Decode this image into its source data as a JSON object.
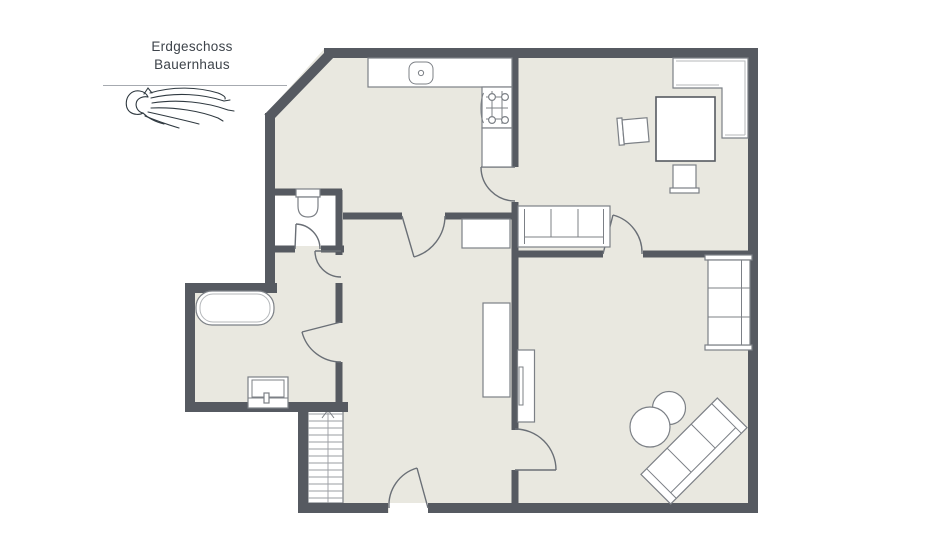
{
  "logo": {
    "title_line1": "Erdgeschoss",
    "title_line2": "Bauernhaus",
    "icon": "horse-line-art-logo"
  },
  "floorplan": {
    "type": "architectural-floor-plan",
    "floor_label": "Erdgeschoss (ground floor)",
    "building_label": "Bauernhaus (farmhouse)",
    "colors": {
      "wall": "#565a61",
      "floor": "#e9e8e0",
      "furniture_fill": "#ffffff",
      "furniture_stroke": "#7c8086",
      "door_arc": "#6a6f76",
      "outside": "#ffffff"
    },
    "rooms": [
      {
        "name": "kitchen",
        "symbols": [
          "kitchen-counter",
          "sink",
          "stove",
          "base-cabinet"
        ]
      },
      {
        "name": "wc",
        "symbols": [
          "toilet"
        ]
      },
      {
        "name": "bathroom",
        "symbols": [
          "bathtub",
          "vanity-washbasin"
        ]
      },
      {
        "name": "hallway",
        "symbols": [
          "staircase-with-up-arrow",
          "wardrobe",
          "sideboard",
          "entrance-door"
        ]
      },
      {
        "name": "dining-living-room",
        "symbols": [
          "corner-bench",
          "dining-table",
          "chair",
          "chair",
          "three-seat-sofa"
        ]
      },
      {
        "name": "lounge-room",
        "symbols": [
          "bookshelf",
          "tv-lowboard",
          "round-pouf-large",
          "round-pouf-small",
          "diagonal-sofa"
        ]
      }
    ],
    "door_swings": 8,
    "stairs": {
      "direction_arrow": "up",
      "runs": 2
    }
  }
}
